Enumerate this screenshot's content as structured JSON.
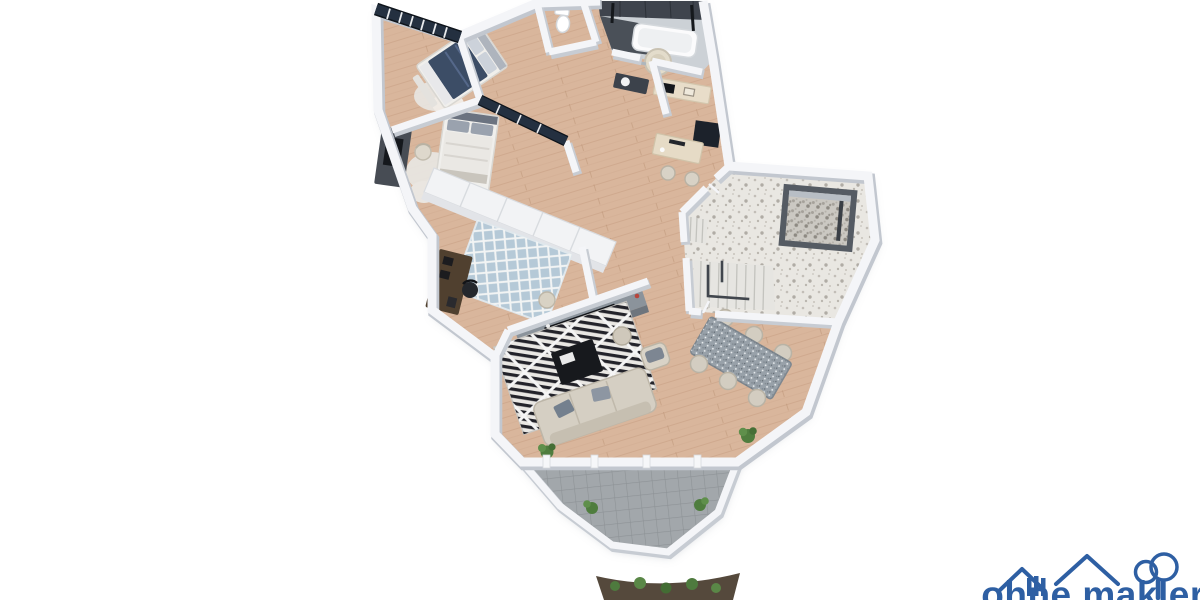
{
  "page": {
    "background": "#ffffff",
    "description": "3D rendered top-down floor plan of an apartment with balcony, no text labels"
  },
  "watermark": {
    "wordmark": "ohne makler",
    "color": "#2e5fa3",
    "icon": "house-and-tree-logo"
  },
  "floorplan": {
    "colors": {
      "wood_floor": "#d9b69c",
      "plank_line": "#c79f82",
      "wall_face": "#f4f5f8",
      "wall_shadow": "#c7ccd3",
      "window_glass": "#243040",
      "bath_tile_dark": "#3f444d",
      "bath_tile_light": "#ccd1d6",
      "terrazzo": "#e9e7e2",
      "paver": "#a2a7ab",
      "rug_white": "#e9e7e3",
      "rug_blue": "#b5c9d7",
      "sofa": "#d5cfc3",
      "cushion": "#74808e",
      "bed_navy": "#3c4d66",
      "bed_white": "#eae8e4",
      "table_gray": "#98a1a9",
      "wood_furniture": "#50402f",
      "dark_furniture": "#474c54",
      "coffee_table": "#17191d",
      "sideboard": "#8b939b",
      "plant_green": "#4f7d3e",
      "soil": "#55493c"
    },
    "rooms": [
      {
        "id": "bedroom-1",
        "furnishings": [
          "double-bed-navy",
          "pillows",
          "bench",
          "fluffy-rug",
          "panorama-window-band"
        ]
      },
      {
        "id": "bedroom-2",
        "furnishings": [
          "double-bed-light",
          "dark-sideboard-tv",
          "armchair",
          "fluffy-rug",
          "glazed-partition"
        ]
      },
      {
        "id": "wc",
        "furnishings": [
          "toilet"
        ]
      },
      {
        "id": "bathroom",
        "furnishings": [
          "bathtub",
          "round-soaking-tub",
          "dark-wall-tiles",
          "shower-fixture",
          "towel-rail"
        ]
      },
      {
        "id": "vanity-room",
        "furnishings": [
          "washbasin-counter",
          "mirror"
        ]
      },
      {
        "id": "kitchen-nook",
        "furnishings": [
          "counter",
          "cooktop",
          "sink",
          "wall-panel-dark"
        ]
      },
      {
        "id": "home-office-nook",
        "furnishings": [
          "desk",
          "monitor",
          "two-stools"
        ]
      },
      {
        "id": "hallway",
        "furnishings": [
          "built-in-wardrobe-row"
        ]
      },
      {
        "id": "kids-room",
        "furnishings": [
          "dark-desk",
          "chair",
          "blue-lattice-rug",
          "pouf"
        ]
      },
      {
        "id": "living-room",
        "furnishings": [
          "long-sideboard",
          "soundbar",
          "bw-diamond-rug",
          "coffee-table-dark",
          "three-seat-sofa",
          "armchair",
          "ottoman",
          "potted-plant"
        ]
      },
      {
        "id": "dining-area",
        "furnishings": [
          "stone-top-table",
          "six-chairs",
          "potted-plant"
        ]
      },
      {
        "id": "stair-lobby",
        "furnishings": [
          "terrazzo-floor",
          "staircase-down",
          "upper-steps",
          "elevator-shaft"
        ]
      },
      {
        "id": "balcony",
        "furnishings": [
          "stone-pavers",
          "parapet",
          "planter-plants",
          "door-posts"
        ]
      },
      {
        "id": "garden-strip",
        "furnishings": [
          "soil",
          "shrubs"
        ]
      }
    ]
  }
}
